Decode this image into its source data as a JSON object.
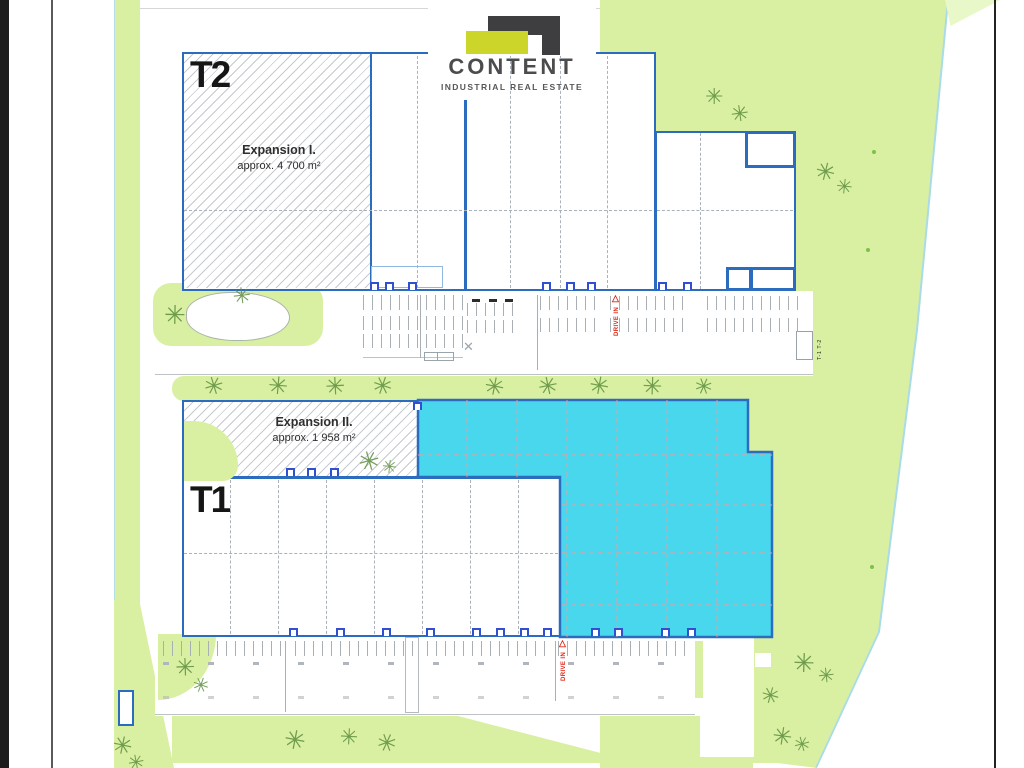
{
  "brand": {
    "name": "CONTENT",
    "tagline": "INDUSTRIAL REAL ESTATE"
  },
  "buildings": {
    "t2": {
      "label": "T2",
      "expansion": {
        "title": "Expansion I.",
        "area": "approx. 4 700 m²"
      }
    },
    "t1": {
      "label": "T1",
      "expansion": {
        "title": "Expansion II.",
        "area": "approx. 1 958 m²"
      }
    }
  },
  "markers": {
    "drive_in_top": "DRIVE IN",
    "drive_in_bottom": "DRIVE IN",
    "gate_label": "T-1 T-2"
  },
  "icons": {
    "tree": "✳",
    "crossed_area": "✕",
    "drive_in_arrow": "△"
  },
  "colors": {
    "building_outline": "#2b6cbf",
    "available_area_cyan": "#49d7ee",
    "landscape_green": "#d9efa2",
    "tree_green": "#5d8f3f",
    "marker_red": "#e02818",
    "logo_dark": "#3e3e40",
    "logo_yellow": "#ccd62a"
  }
}
